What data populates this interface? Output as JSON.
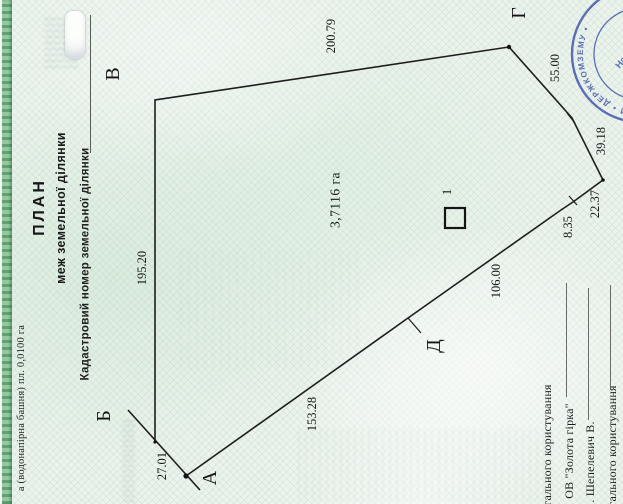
{
  "document": {
    "title": "ПЛАН",
    "subtitle": "меж земельної ділянки",
    "cadastral_label": "Кадастровий номер земельної ділянки",
    "left_note": "а (водонапірна башня) пл. 0,0100 га"
  },
  "plan": {
    "area_label": {
      "text": "3,7116 га",
      "x": 335,
      "y": 200
    },
    "parcel_number": {
      "text": "1",
      "x": 447,
      "y": 192
    },
    "symbol_square": {
      "x": 445,
      "y": 208,
      "size": 20
    },
    "outline_points": "155,442 155,100 509,47 572,118 603,180 573,202 561,210 408,318 186,476",
    "extra_lines": [
      {
        "x1": 128,
        "y1": 410,
        "x2": 200,
        "y2": 490,
        "w": 1.6
      },
      {
        "x1": 408,
        "y1": 318,
        "x2": 421,
        "y2": 333,
        "w": 1.2
      },
      {
        "x1": 569,
        "y1": 196,
        "x2": 577,
        "y2": 205,
        "w": 1.2
      },
      {
        "x1": 567,
        "y1": 113,
        "x2": 575,
        "y2": 123,
        "w": 1.2
      }
    ],
    "dots": [
      {
        "x": 186,
        "y": 476,
        "r": 2.6
      },
      {
        "x": 509,
        "y": 47,
        "r": 2.2
      },
      {
        "x": 603,
        "y": 180,
        "r": 1.8
      },
      {
        "x": 155,
        "y": 442,
        "r": 1.6
      }
    ],
    "vertex_labels": [
      {
        "text": "А",
        "x": 210,
        "y": 478
      },
      {
        "text": "Б",
        "x": 104,
        "y": 416
      },
      {
        "text": "В",
        "x": 113,
        "y": 74
      },
      {
        "text": "Г",
        "x": 519,
        "y": 13
      },
      {
        "text": "Д",
        "x": 434,
        "y": 346
      }
    ],
    "edge_labels": [
      {
        "text": "200.79",
        "x": 331,
        "y": 36
      },
      {
        "text": "195.20",
        "x": 142,
        "y": 268
      },
      {
        "text": "55.00",
        "x": 555,
        "y": 68
      },
      {
        "text": "39.18",
        "x": 601,
        "y": 141
      },
      {
        "text": "22.37",
        "x": 595,
        "y": 204
      },
      {
        "text": "8.35",
        "x": 568,
        "y": 227
      },
      {
        "text": "106.00",
        "x": 496,
        "y": 281
      },
      {
        "text": "153.28",
        "x": 312,
        "y": 414
      },
      {
        "text": "27.01",
        "x": 162,
        "y": 466
      }
    ]
  },
  "legend_rows": [
    {
      "text": "гального користування",
      "x": 547,
      "y": 445
    },
    {
      "text": "ОВ \"Золота гірка\"",
      "x": 569,
      "y": 451,
      "line": {
        "x": 566,
        "y1": 283,
        "y2": 397
      }
    },
    {
      "text": ". Шепелевич В.",
      "x": 590,
      "y": 462,
      "line": {
        "x": 588,
        "y1": 288,
        "y2": 420
      }
    },
    {
      "text": "гального користування",
      "x": 612,
      "y": 446,
      "line": {
        "x": 610,
        "y1": 285,
        "y2": 390
      }
    }
  ],
  "stamp": {
    "ring_text": "ДЕРЖАВНИЙ КОМІТЕТ УКРАЇНИ  •  ДЕРЖКОМЗЕМУ  •",
    "inner_line1": "Начальник",
    "inner_line2": "управління",
    "big_text": "МІ",
    "color": "#3d51aa"
  },
  "colors": {
    "paper": "#ebf3ec",
    "ink": "#1c1c1c",
    "edge_green": "#7cb489",
    "stamp_blue": "#3d51aa"
  }
}
